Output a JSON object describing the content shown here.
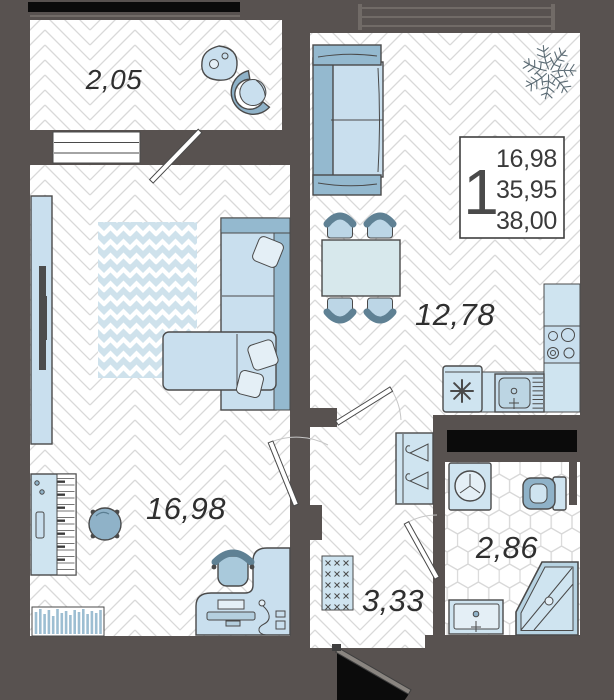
{
  "floor_plan": {
    "title": "one-room apartment floor plan",
    "rooms": [
      {
        "name": "balcony",
        "area": "2,05"
      },
      {
        "name": "living-room",
        "area": "16,98"
      },
      {
        "name": "kitchen-living-room",
        "area": "12,78"
      },
      {
        "name": "hallway",
        "area": "3,33"
      },
      {
        "name": "bathroom",
        "area": "2,86"
      }
    ],
    "info_box": {
      "rooms_count": "1",
      "living_area": "16,98",
      "area_without_balcony": "35,95",
      "total_area": "38,00"
    },
    "colors": {
      "wall": "#585250",
      "glazing": "#0b0b0b",
      "furniture_light": "#cfe4f0",
      "furniture_medium": "#94b9cf",
      "furniture_dark": "#6e90a5",
      "outline": "#4a4a4a",
      "floor_line": "#d9d9d9",
      "label_text": "#2f2f2f"
    }
  }
}
